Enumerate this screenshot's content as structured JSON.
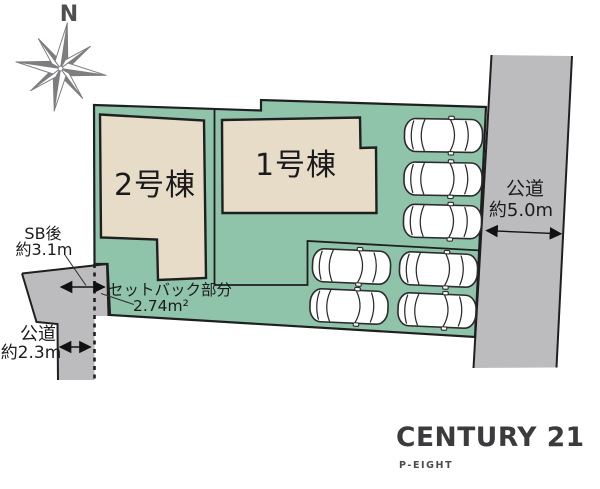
{
  "plan": {
    "compass": {
      "north_label": "N"
    },
    "units": {
      "unit2_label": "2号棟",
      "unit1_label": "1号棟"
    },
    "setback": {
      "after_label": "SB後",
      "after_value": "約3.1m",
      "part_label": "セットバック部分",
      "part_area": "2.74m²"
    },
    "road_west": {
      "name": "公道",
      "width": "約2.3m"
    },
    "road_east": {
      "name": "公道",
      "width": "約5.0m"
    },
    "parking": {
      "car_count": 7
    }
  },
  "branding": {
    "company": "CENTURY 21",
    "office": "P-EIGHT"
  },
  "colors": {
    "plot_green": "#8fc3aa",
    "building_beige": "#e6dcc7",
    "road_gray": "#bcbcbe",
    "outline": "#1f1f1f",
    "brand_text": "#3b3b3d"
  }
}
